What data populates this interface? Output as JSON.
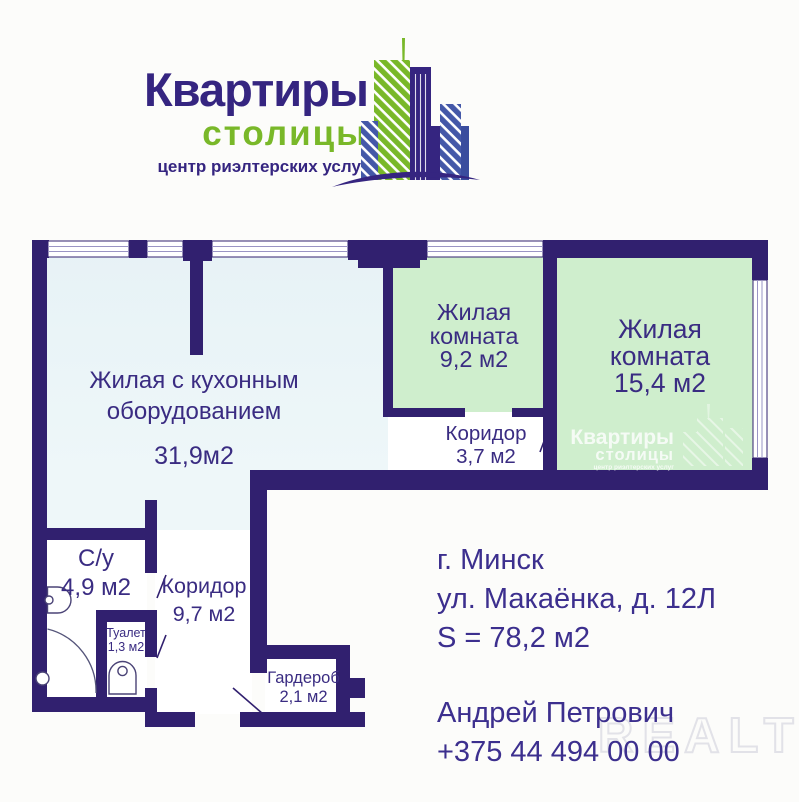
{
  "logo": {
    "title": "Квартиры",
    "subtitle": "столицы",
    "tagline": "центр риэлтерских услуг"
  },
  "floorplan": {
    "rooms": [
      {
        "label": "Жилая с кухонным оборудованием",
        "area": "31,9м2"
      },
      {
        "label": "Жилая комната",
        "area": "9,2 м2"
      },
      {
        "label": "Жилая комната",
        "area": "15,4 м2"
      },
      {
        "label": "Коридор",
        "area": "3,7 м2"
      },
      {
        "label": "С/у",
        "area": "4,9 м2"
      },
      {
        "label": "Туалет",
        "area": "1,3 м2"
      },
      {
        "label": "Коридор",
        "area": "9,7 м2"
      },
      {
        "label": "Гардероб",
        "area": "2,1 м2"
      }
    ],
    "brand_watermark": {
      "line1": "Квартиры",
      "line2": "столицы",
      "line3": "центр риэлтерских услуг"
    }
  },
  "details": {
    "city": "г. Минск",
    "street": "ул. Макаёнка, д. 12Л",
    "total_area": "S = 78,2 м2",
    "agent": "Андрей Петрович",
    "phone": "+375 44 494 00 00"
  },
  "site_watermark": "REALT",
  "colors": {
    "wall": "#31206f",
    "room_green": "#cfeecd",
    "room_blue": "#e8f3f6",
    "floor_white": "#ffffff",
    "logo_navy": "#352580",
    "logo_green": "#79b829",
    "logo_blue": "#4458a8",
    "text": "#3a2c82",
    "watermark_gray": "#e2e2e8"
  }
}
